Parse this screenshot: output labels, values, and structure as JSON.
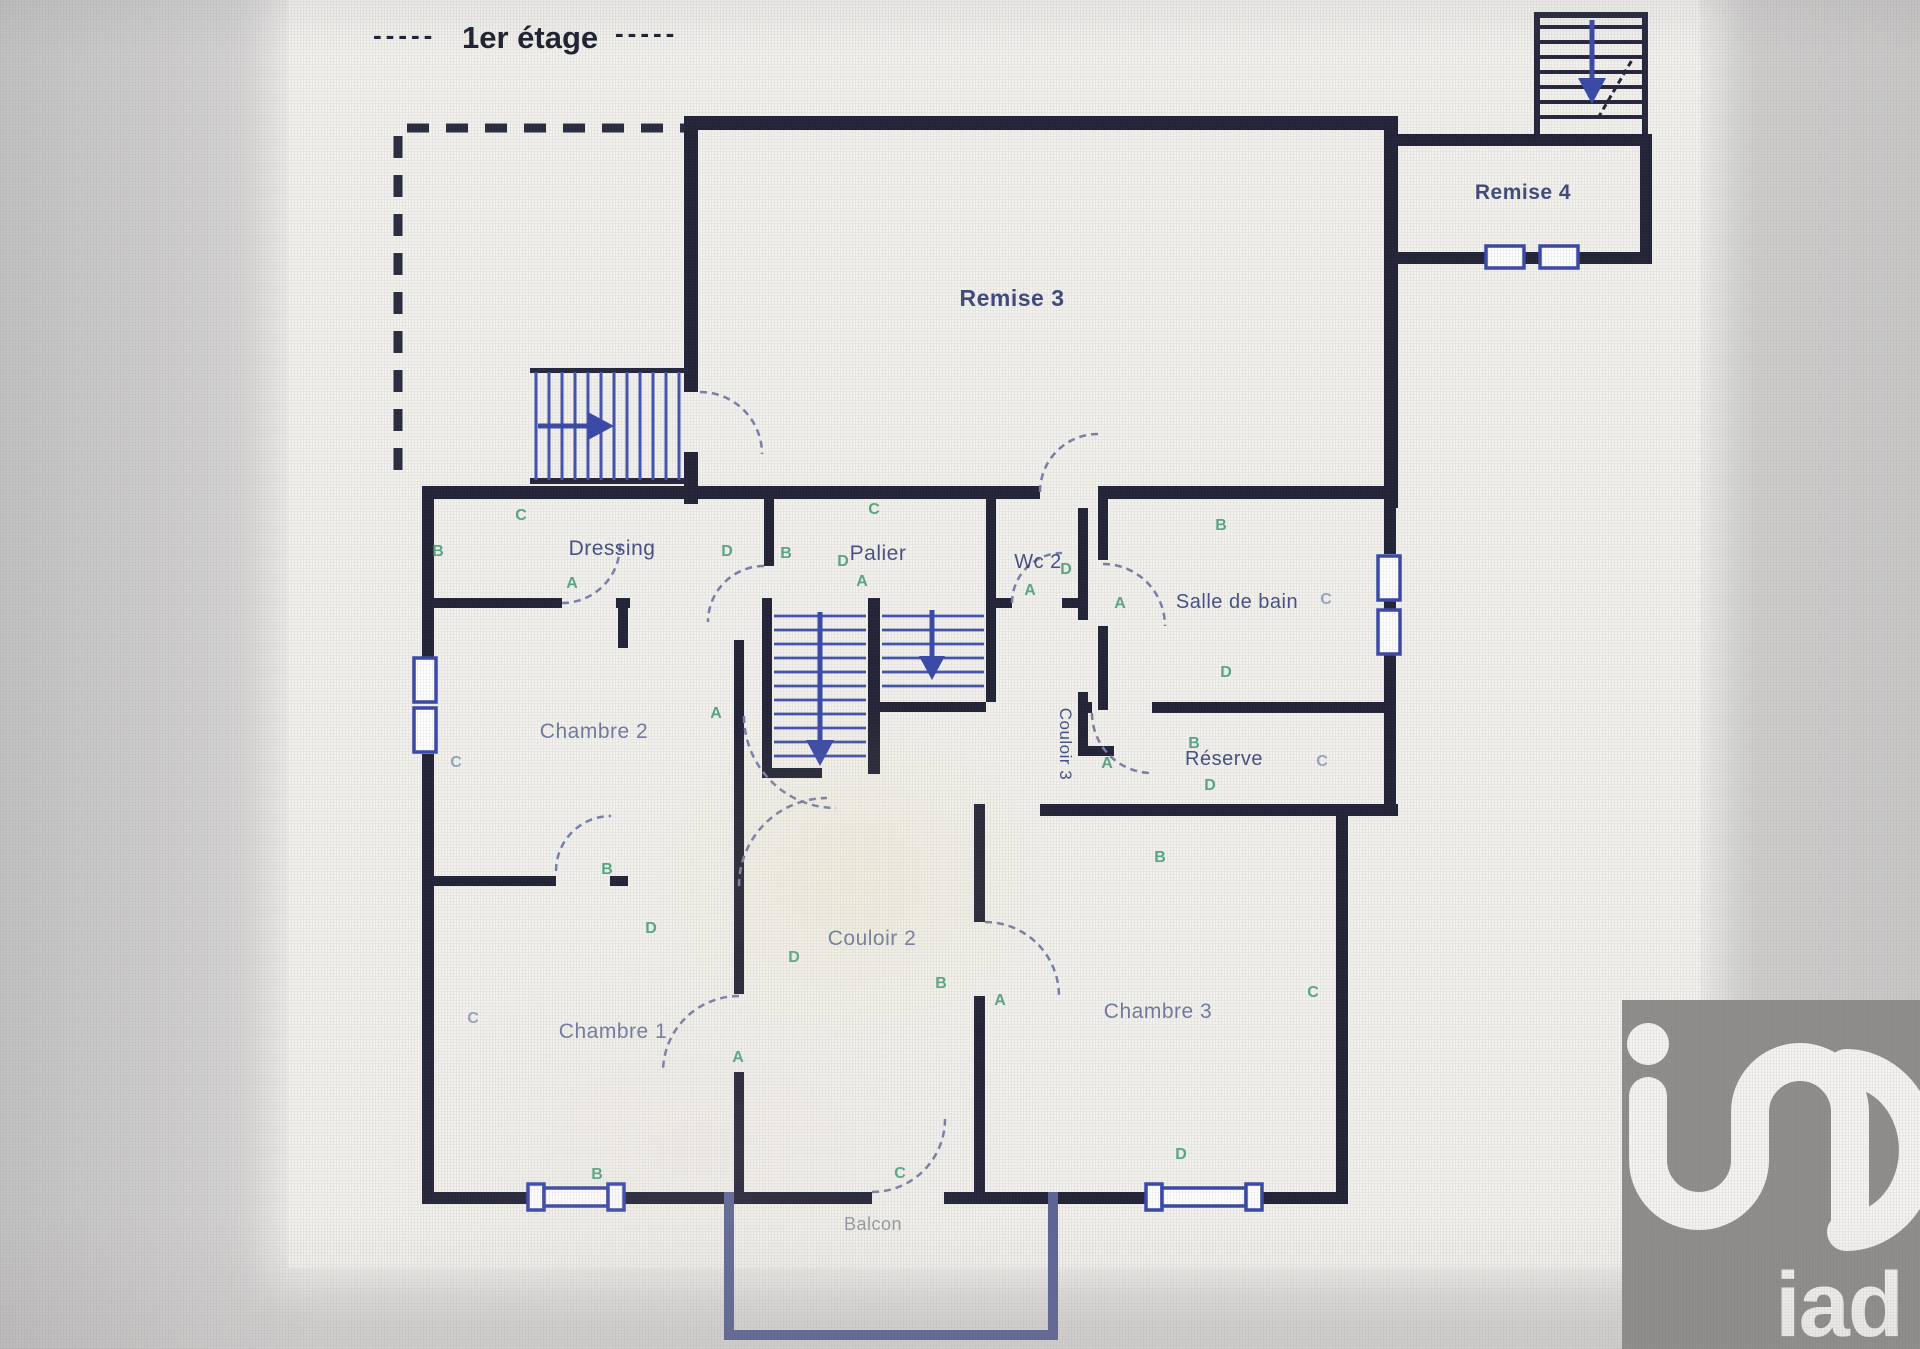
{
  "title": {
    "prefix": "-----",
    "label": "1er étage",
    "suffix": "-----"
  },
  "rooms": [
    {
      "label": "Remise 3"
    },
    {
      "label": "Remise 4"
    },
    {
      "label": "Dressing"
    },
    {
      "label": "Palier"
    },
    {
      "label": "Wc 2"
    },
    {
      "label": "Salle de bain"
    },
    {
      "label": "Chambre 2"
    },
    {
      "label": "Couloir 3"
    },
    {
      "label": "Réserve"
    },
    {
      "label": "Couloir 2"
    },
    {
      "label": "Chambre 1"
    },
    {
      "label": "Chambre 3"
    },
    {
      "label": "Balcon"
    }
  ],
  "markers": [
    {
      "t": "B"
    },
    {
      "t": "C"
    },
    {
      "t": "A"
    },
    {
      "t": "D"
    },
    {
      "t": "B"
    },
    {
      "t": "C"
    },
    {
      "t": "A"
    },
    {
      "t": "D"
    },
    {
      "t": "D"
    },
    {
      "t": "A"
    },
    {
      "t": "B"
    },
    {
      "t": "A"
    },
    {
      "t": "C"
    },
    {
      "t": "D"
    },
    {
      "t": "B"
    },
    {
      "t": "D"
    },
    {
      "t": "A"
    },
    {
      "t": "C"
    },
    {
      "t": "A"
    },
    {
      "t": "C"
    },
    {
      "t": "B"
    },
    {
      "t": "D"
    },
    {
      "t": "D"
    },
    {
      "t": "B"
    },
    {
      "t": "A"
    },
    {
      "t": "B"
    },
    {
      "t": "C"
    },
    {
      "t": "C"
    },
    {
      "t": "A"
    },
    {
      "t": "B"
    },
    {
      "t": "C"
    },
    {
      "t": "D"
    }
  ],
  "logo": {
    "text": "iad"
  },
  "colors": {
    "wall": "#232337",
    "wall_blue": "#3a49a8",
    "wall_steel": "#5e6697",
    "marker_green": "#3f9c73",
    "marker_blue": "#8b97bd",
    "label_navy": "#2e3c74",
    "label_slate": "#5f6d96",
    "paper": "#f2f1ec",
    "logo_bg": "#908e8b",
    "logo_fg": "#f4f3f0"
  }
}
